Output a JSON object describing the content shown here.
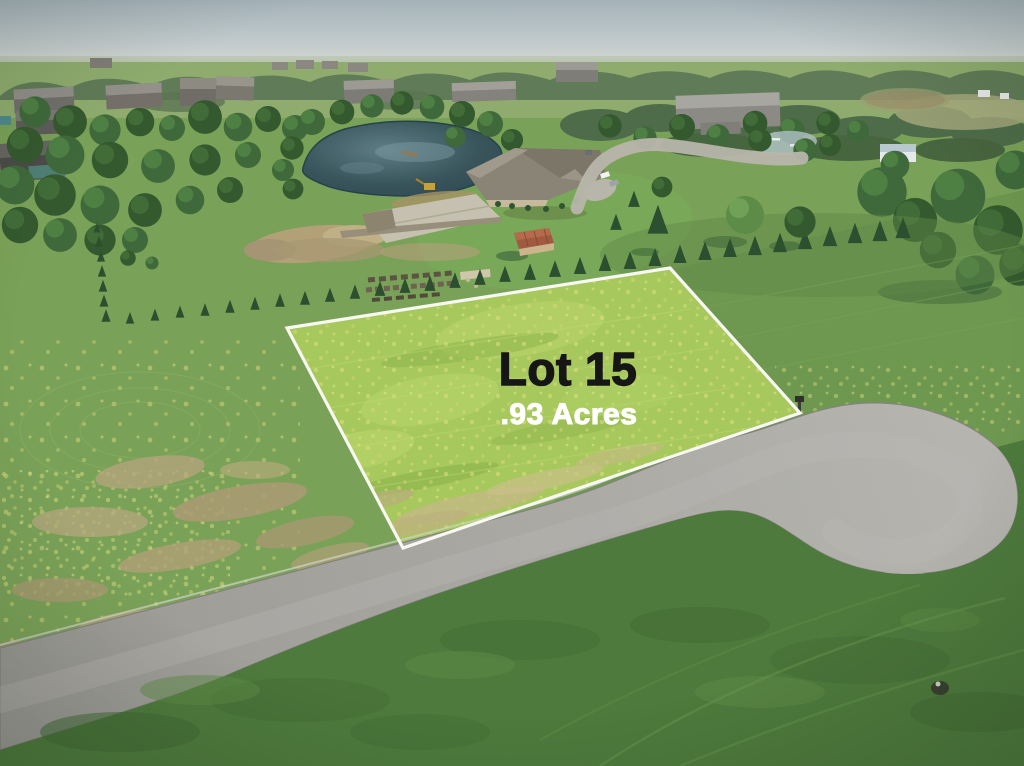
{
  "image": {
    "type": "aerial-drone-photo",
    "subject": "Vacant residential lot outlined in white next to a cul-de-sac street, with fields, pond, construction site, houses and tree rows"
  },
  "overlay": {
    "lot_label": "Lot 15",
    "acreage_label": ".93 Acres"
  },
  "style": {
    "lot_label_color": "#161616",
    "acreage_label_color": "#ffffff",
    "lot_border_color": "#f8f8f2",
    "lot_fill": "#a6c85c",
    "field_green": "#7aa158",
    "right_field_green": "#6e9750",
    "dark_grass": "#4e7a3d",
    "road_gray": "#a7a6a1",
    "pond_water": "#3a545e",
    "evergreen": "#2b4f2f",
    "shed_roof_rust": "#a05a41",
    "sky_gray_blue": "#a4b2b9"
  }
}
